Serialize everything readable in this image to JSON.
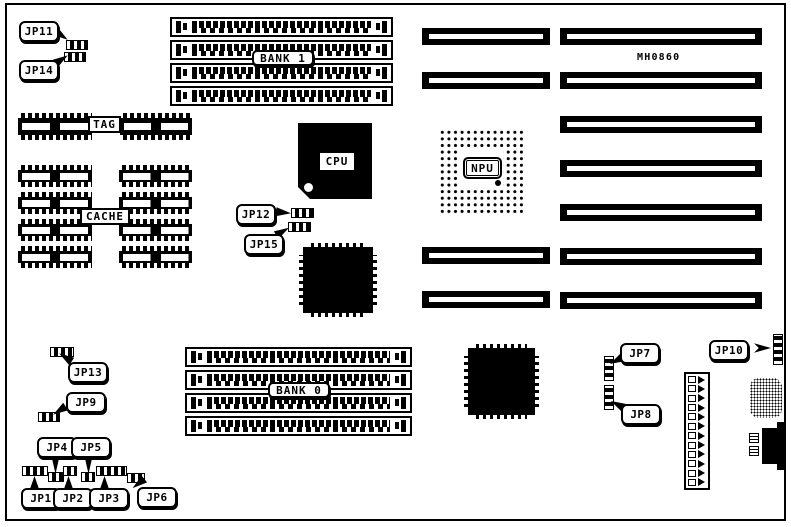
{
  "colors": {
    "ink": "#000000",
    "paper": "#ffffff"
  },
  "board": {
    "part_number": "MH0860",
    "memory_banks": [
      {
        "label": "BANK 1",
        "slot_count": 4
      },
      {
        "label": "BANK 0",
        "slot_count": 4
      }
    ],
    "processors": [
      {
        "label": "CPU"
      },
      {
        "label": "NPU"
      }
    ],
    "memory_labels": [
      {
        "label": "TAG"
      },
      {
        "label": "CACHE"
      }
    ],
    "tag_chip_blocks": 2,
    "cache_chip_blocks": 8,
    "expansion": {
      "long_slot_count": 7,
      "short_slot_count_top": 2,
      "short_slot_count_bottom": 2
    },
    "power_connector_pin_rows": 12,
    "jumpers": [
      {
        "label": "JP1"
      },
      {
        "label": "JP2"
      },
      {
        "label": "JP3"
      },
      {
        "label": "JP4"
      },
      {
        "label": "JP5"
      },
      {
        "label": "JP6"
      },
      {
        "label": "JP7"
      },
      {
        "label": "JP8"
      },
      {
        "label": "JP9"
      },
      {
        "label": "JP10"
      },
      {
        "label": "JP11"
      },
      {
        "label": "JP12"
      },
      {
        "label": "JP13"
      },
      {
        "label": "JP14"
      },
      {
        "label": "JP15"
      }
    ]
  }
}
